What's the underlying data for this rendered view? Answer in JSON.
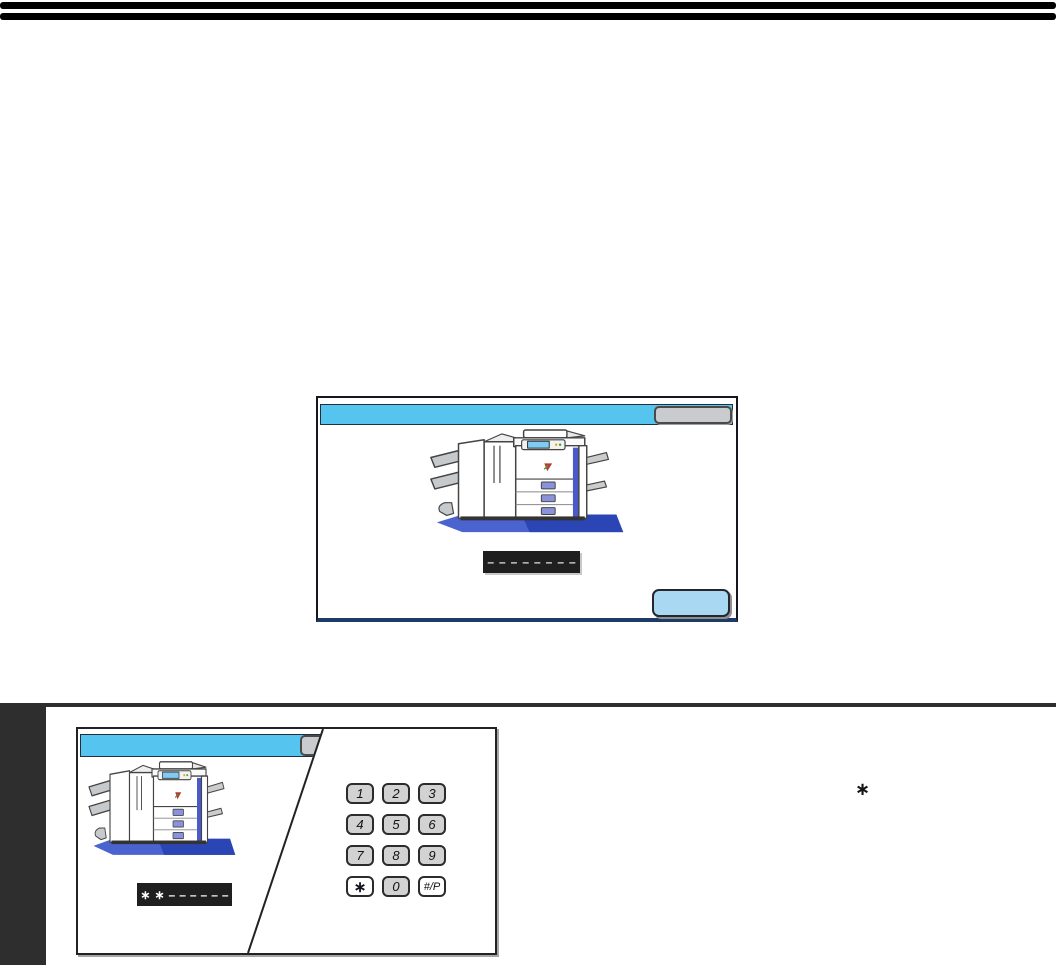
{
  "page": {
    "background": "#ffffff",
    "top_rule_color": "#000000",
    "chapter_tab_color": "#2e2e2e",
    "annotation_asterisk": "∗"
  },
  "touch_panel": {
    "header_color": "#55c5f0",
    "panel_border_bottom_color": "#1e3a66",
    "header_button_color": "#c9cbce",
    "display": {
      "value": "––––––––",
      "background": "#1f1f1f",
      "text_color": "#e6e6e6"
    },
    "action_button_color": "#a9d8f2"
  },
  "figure": {
    "header_color": "#55c5f0",
    "display": {
      "value": "∗∗––––––",
      "background": "#1f1f1f",
      "text_color": "#ffffff"
    },
    "keypad": {
      "key_color": "#d2d2d2",
      "special_key_color": "#ffffff",
      "keys": [
        {
          "label": "1"
        },
        {
          "label": "2"
        },
        {
          "label": "3"
        },
        {
          "label": "4"
        },
        {
          "label": "5"
        },
        {
          "label": "6"
        },
        {
          "label": "7"
        },
        {
          "label": "8"
        },
        {
          "label": "9"
        },
        {
          "label": "∗"
        },
        {
          "label": "0"
        },
        {
          "label": "#/P"
        }
      ]
    }
  }
}
